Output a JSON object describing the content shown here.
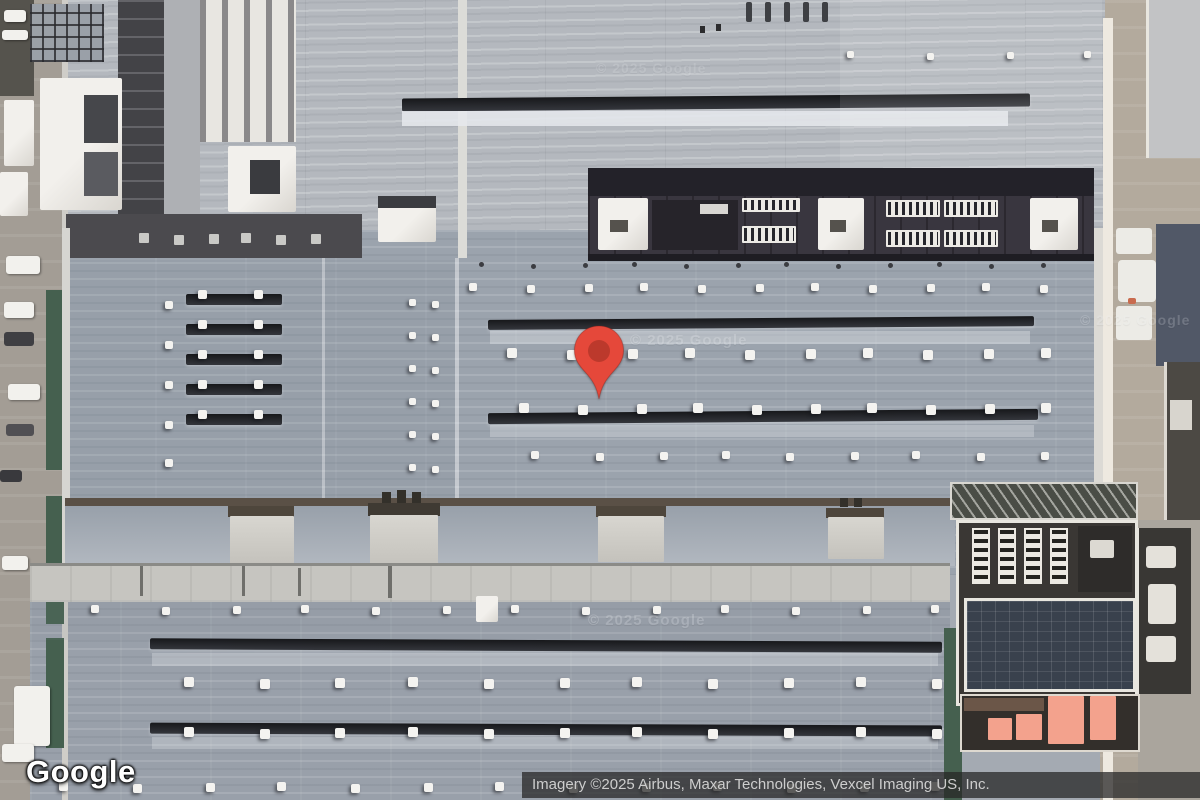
{
  "branding": {
    "logo_text": "Google"
  },
  "attribution": {
    "text": "Imagery ©2025 Airbus, Maxar Technologies, Vexcel Imaging US, Inc."
  },
  "watermark": {
    "text": "© 2025 Google"
  },
  "marker": {
    "name": "location-pin",
    "body_color": "#E5483A",
    "inner_color": "#BC392C"
  }
}
